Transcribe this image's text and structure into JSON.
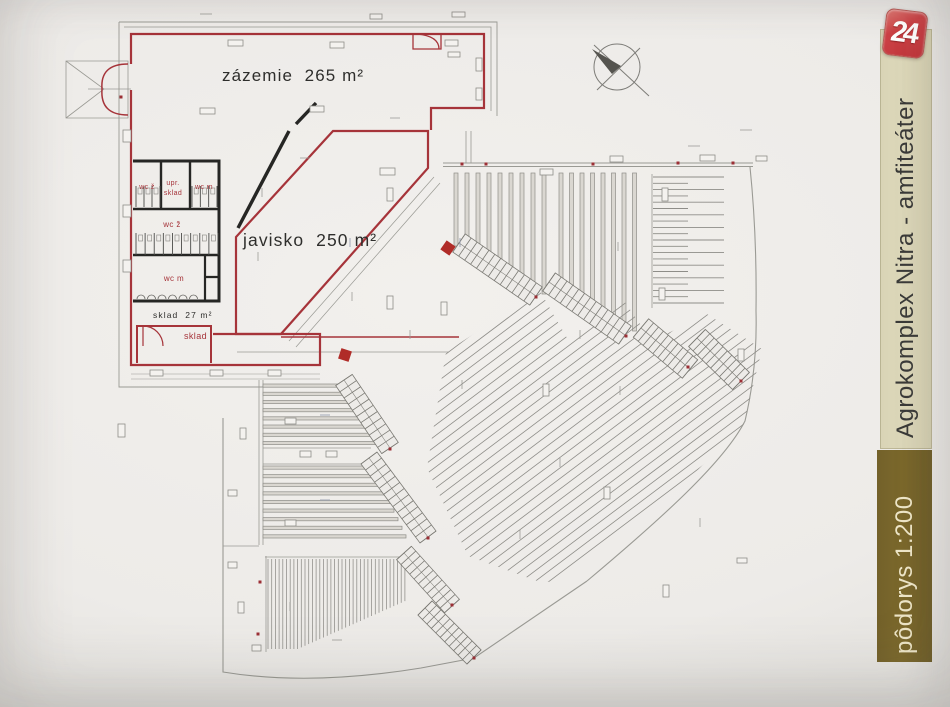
{
  "sidebar": {
    "logo_text": "24",
    "title": "Agrokomplex Nitra - amfiteáter",
    "scale_label": "pôdorys 1:200"
  },
  "plan": {
    "labels": {
      "zazemie": "zázemie  265 m²",
      "javisko": "javisko  250 m²",
      "sklad_area": "sklad  27 m²",
      "sklad_room": "sklad",
      "wc_women_top": "wc ž",
      "upr_line1": "upr.",
      "upr_line2": "sklad",
      "wc_men_top": "wc m",
      "wc_women_main": "wc ž",
      "wc_men_main": "wc m"
    }
  },
  "colors": {
    "accent_red": "#a6343a",
    "wall_black": "#262624",
    "plan_gray": "#8e8d88",
    "paper": "#edebe8",
    "title_bar": "#ddd8ba",
    "scale_bar": "#7c692c",
    "scale_text": "#efe7c9",
    "logo_red": "#c0353b"
  }
}
